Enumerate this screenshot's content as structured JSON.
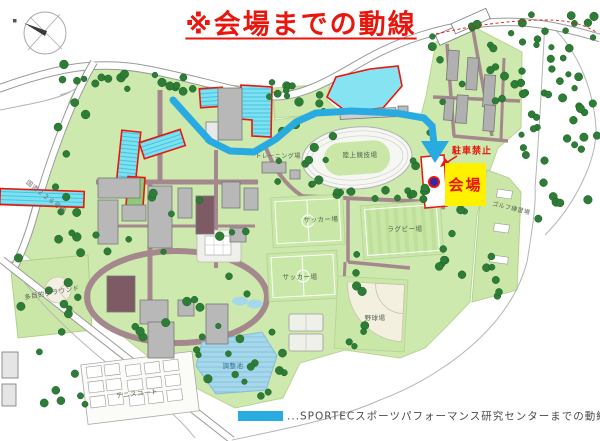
{
  "title": {
    "text": "※会場までの動線"
  },
  "annotations": {
    "venue_label": "会場",
    "no_parking_label": "駐車禁止"
  },
  "legend": {
    "text": "...SPORTECスポーツパフォーマンス研究センターまでの動線",
    "swatch_color": "#29abe2"
  },
  "places": {
    "athletics_track": "陸上競技場",
    "training_ground": "トレーニング場",
    "soccer_field_upper": "サッカー場",
    "rugby_field": "ラグビー場",
    "soccer_field_lower": "サッカー場",
    "baseball_field": "野球場",
    "regulating_pond": "調整池",
    "tennis_courts": "テニスコート",
    "multipurpose_ground": "多目的グラウンド",
    "golf_driving_range": "ゴルフ練習場",
    "road_name": "国道２２６号線"
  },
  "colors": {
    "route_blue": "#29abe2",
    "highlight_red": "#e8160c",
    "venue_yellow": "#fff100",
    "parking_cyan": "#7de1f1",
    "campus_green": "#cde9ad",
    "building_gray": "#b8b8b8",
    "internal_road_brown": "#a5878e"
  }
}
